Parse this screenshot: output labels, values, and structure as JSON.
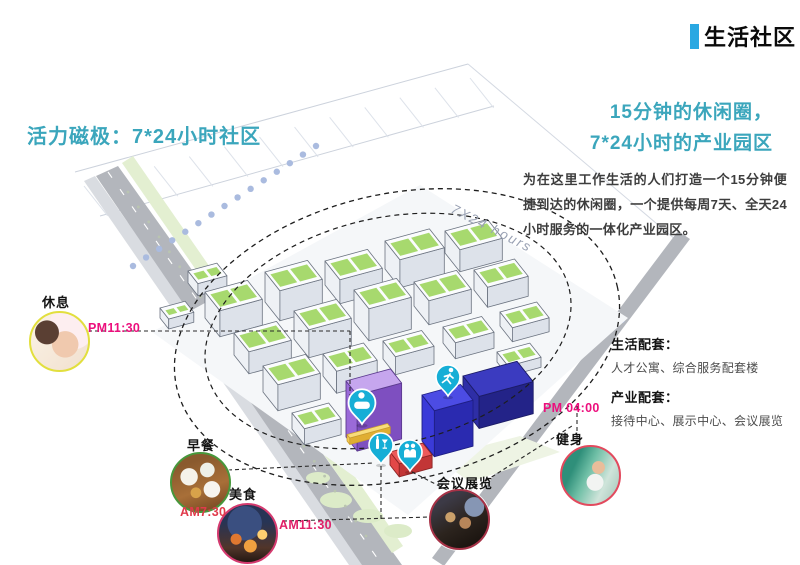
{
  "page": {
    "title": "生活社区"
  },
  "headings": {
    "left_title": "活力磁极：7*24小时社区",
    "right_title_line1": "15分钟的休闲圈，",
    "right_title_line2": "7*24小时的产业园区"
  },
  "intro": "为在这里工作生活的人们打造一个15分钟便捷到达的休闲圈，一个提供每周7天、全天24小时服务的一体化产业园区。",
  "annotations": {
    "life": {
      "label": "生活配套：",
      "content": "人才公寓、综合服务配套楼"
    },
    "industry": {
      "label": "产业配套：",
      "content": "接待中心、展示中心、会议展览"
    }
  },
  "map": {
    "ellipse_label": "7X24 hours"
  },
  "callouts": [
    {
      "id": "rest",
      "label": "休息",
      "time": "PM11:30",
      "ring_color": "#e2df3e",
      "time_color": "#ec0f7d"
    },
    {
      "id": "breakfast",
      "label": "早餐",
      "time": "AM7:30",
      "ring_color": "#47973b",
      "time_color": "#e03a4b"
    },
    {
      "id": "food",
      "label": "美食",
      "time": "AM11:30",
      "ring_color": "#d43a6f",
      "time_color": "#e01f68"
    },
    {
      "id": "fitness",
      "label": "健身",
      "time": "PM 04:00",
      "ring_color": "#e24a5e",
      "time_color": "#ec0f7d"
    },
    {
      "id": "conference",
      "label": "会议展览",
      "time": "",
      "ring_color": "#a63247",
      "time_color": ""
    }
  ],
  "pins": [
    {
      "id": "spa",
      "icon": "spa-bath-icon"
    },
    {
      "id": "drinks",
      "icon": "drinks-icon"
    },
    {
      "id": "people",
      "icon": "people-icon"
    },
    {
      "id": "running",
      "icon": "running-icon"
    }
  ],
  "colors": {
    "accent": "#29a8e2",
    "heading": "#3ba6bc",
    "pin": "#16aed6",
    "time_magenta": "#ec0f7d"
  }
}
